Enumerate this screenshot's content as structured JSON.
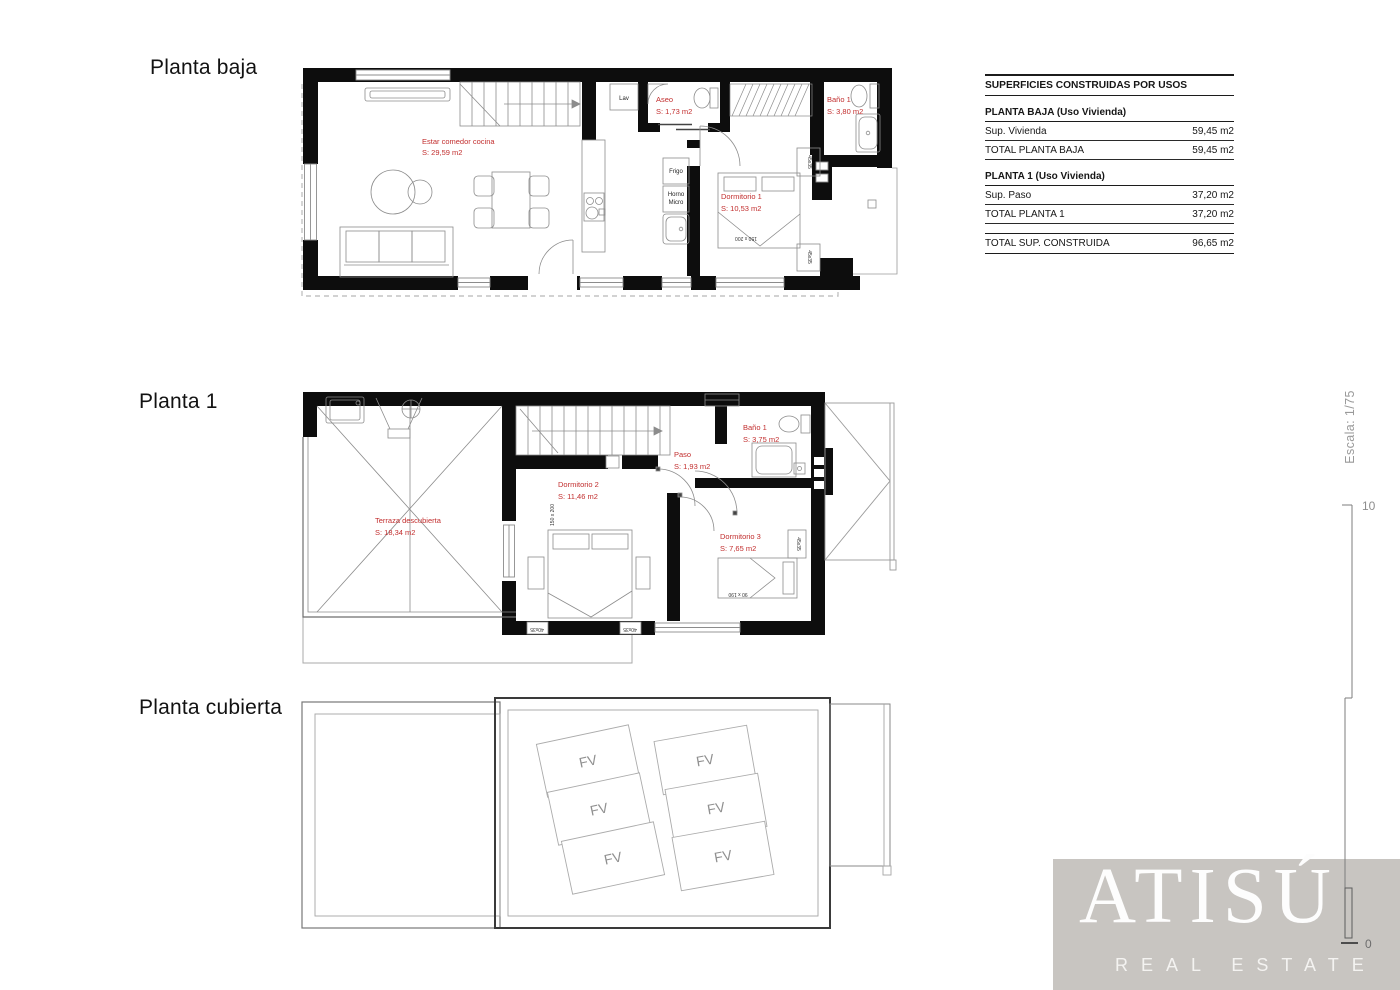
{
  "document": {
    "background": "#ffffff"
  },
  "titles": [
    {
      "label": "Planta baja"
    },
    {
      "label": "Planta 1"
    },
    {
      "label": "Planta cubierta"
    }
  ],
  "floors": {
    "ground": {
      "rooms": [
        {
          "name": "Estar comedor cocina",
          "area": "S: 29,59 m2"
        },
        {
          "name": "Aseo",
          "area": "S: 1,73 m2"
        },
        {
          "name": "Baño 1",
          "area": "S: 3,80 m2"
        },
        {
          "name": "Dormitorio 1",
          "area": "S: 10,53 m2"
        }
      ],
      "fixtures": {
        "laundry": "Lav",
        "fridge": "Frigo",
        "oven": "Horno",
        "micro": "Micro",
        "bed_size": "150 x 200",
        "nightstand": "45x35"
      }
    },
    "first": {
      "rooms": [
        {
          "name": "Terraza descubierta",
          "area": "S: 18,34 m2"
        },
        {
          "name": "Dormitorio 2",
          "area": "S: 11,46 m2"
        },
        {
          "name": "Paso",
          "area": "S: 1,93 m2"
        },
        {
          "name": "Baño 1",
          "area": "S: 3,75 m2"
        },
        {
          "name": "Dormitorio 3",
          "area": "S: 7,65 m2"
        }
      ],
      "fixtures": {
        "bed_size": "150 x 200",
        "bed3_size": "90 x 190",
        "nightstand": "40x35",
        "nightstand3": "45x35"
      }
    },
    "roof": {
      "panels": [
        {
          "label": "FV"
        },
        {
          "label": "FV"
        },
        {
          "label": "FV"
        },
        {
          "label": "FV"
        },
        {
          "label": "FV"
        },
        {
          "label": "FV"
        }
      ]
    }
  },
  "areas_table": {
    "title": "SUPERFICIES CONSTRUIDAS POR USOS",
    "sections": [
      {
        "heading": "PLANTA BAJA (Uso Vivienda)",
        "rows": [
          {
            "label": "Sup. Vivienda",
            "value": "59,45 m2"
          },
          {
            "label": "TOTAL PLANTA BAJA",
            "value": "59,45 m2"
          }
        ]
      },
      {
        "heading": "PLANTA 1 (Uso Vivienda)",
        "rows": [
          {
            "label": "Sup. Paso",
            "value": "37,20 m2"
          },
          {
            "label": "TOTAL PLANTA 1",
            "value": "37,20 m2"
          }
        ]
      }
    ],
    "total": {
      "label": "TOTAL SUP. CONSTRUIDA",
      "value": "96,65 m2"
    }
  },
  "scale": {
    "label": "Escala: 1/75",
    "ruler_top": "10",
    "ruler_bottom": "0"
  },
  "brand": {
    "name": "ATISÚ",
    "tagline": "REAL ESTATE",
    "panel_color": "#c8c5c1"
  },
  "colors": {
    "wall": "#0d0d0d",
    "furniture_line": "#8c8c8c",
    "room_label": "#c22e2e",
    "dashed_outline": "#c4c4c4"
  }
}
